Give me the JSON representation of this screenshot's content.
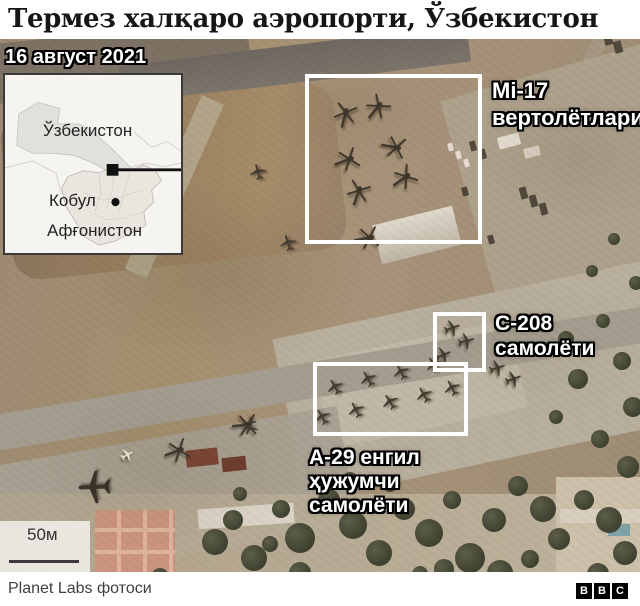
{
  "title": "Термез халқаро аэропорти, Ўзбекистон",
  "map": {
    "date_label": "16 август 2021",
    "inset": {
      "country_top": "Ўзбекистон",
      "city": "Кобул",
      "country_bottom": "Афғонистон"
    },
    "annotations": {
      "mi17_line1": "Mi-17",
      "mi17_line2": "вертолётлари",
      "c208_line1": "C-208",
      "c208_line2": "самолёти",
      "a29_line1": "A-29 енгил",
      "a29_line2": "ҳужумчи",
      "a29_line3": "самолёти"
    },
    "scale_label": "50м"
  },
  "footer": {
    "credit": "Planet Labs фотоси",
    "logo_letters": [
      "B",
      "B",
      "C"
    ]
  },
  "colors": {
    "annotation_box": "#ffffff",
    "annotation_text": "#ffffff",
    "title_text": "#161616",
    "footer_text": "#404040",
    "logo_bg": "#000000"
  }
}
